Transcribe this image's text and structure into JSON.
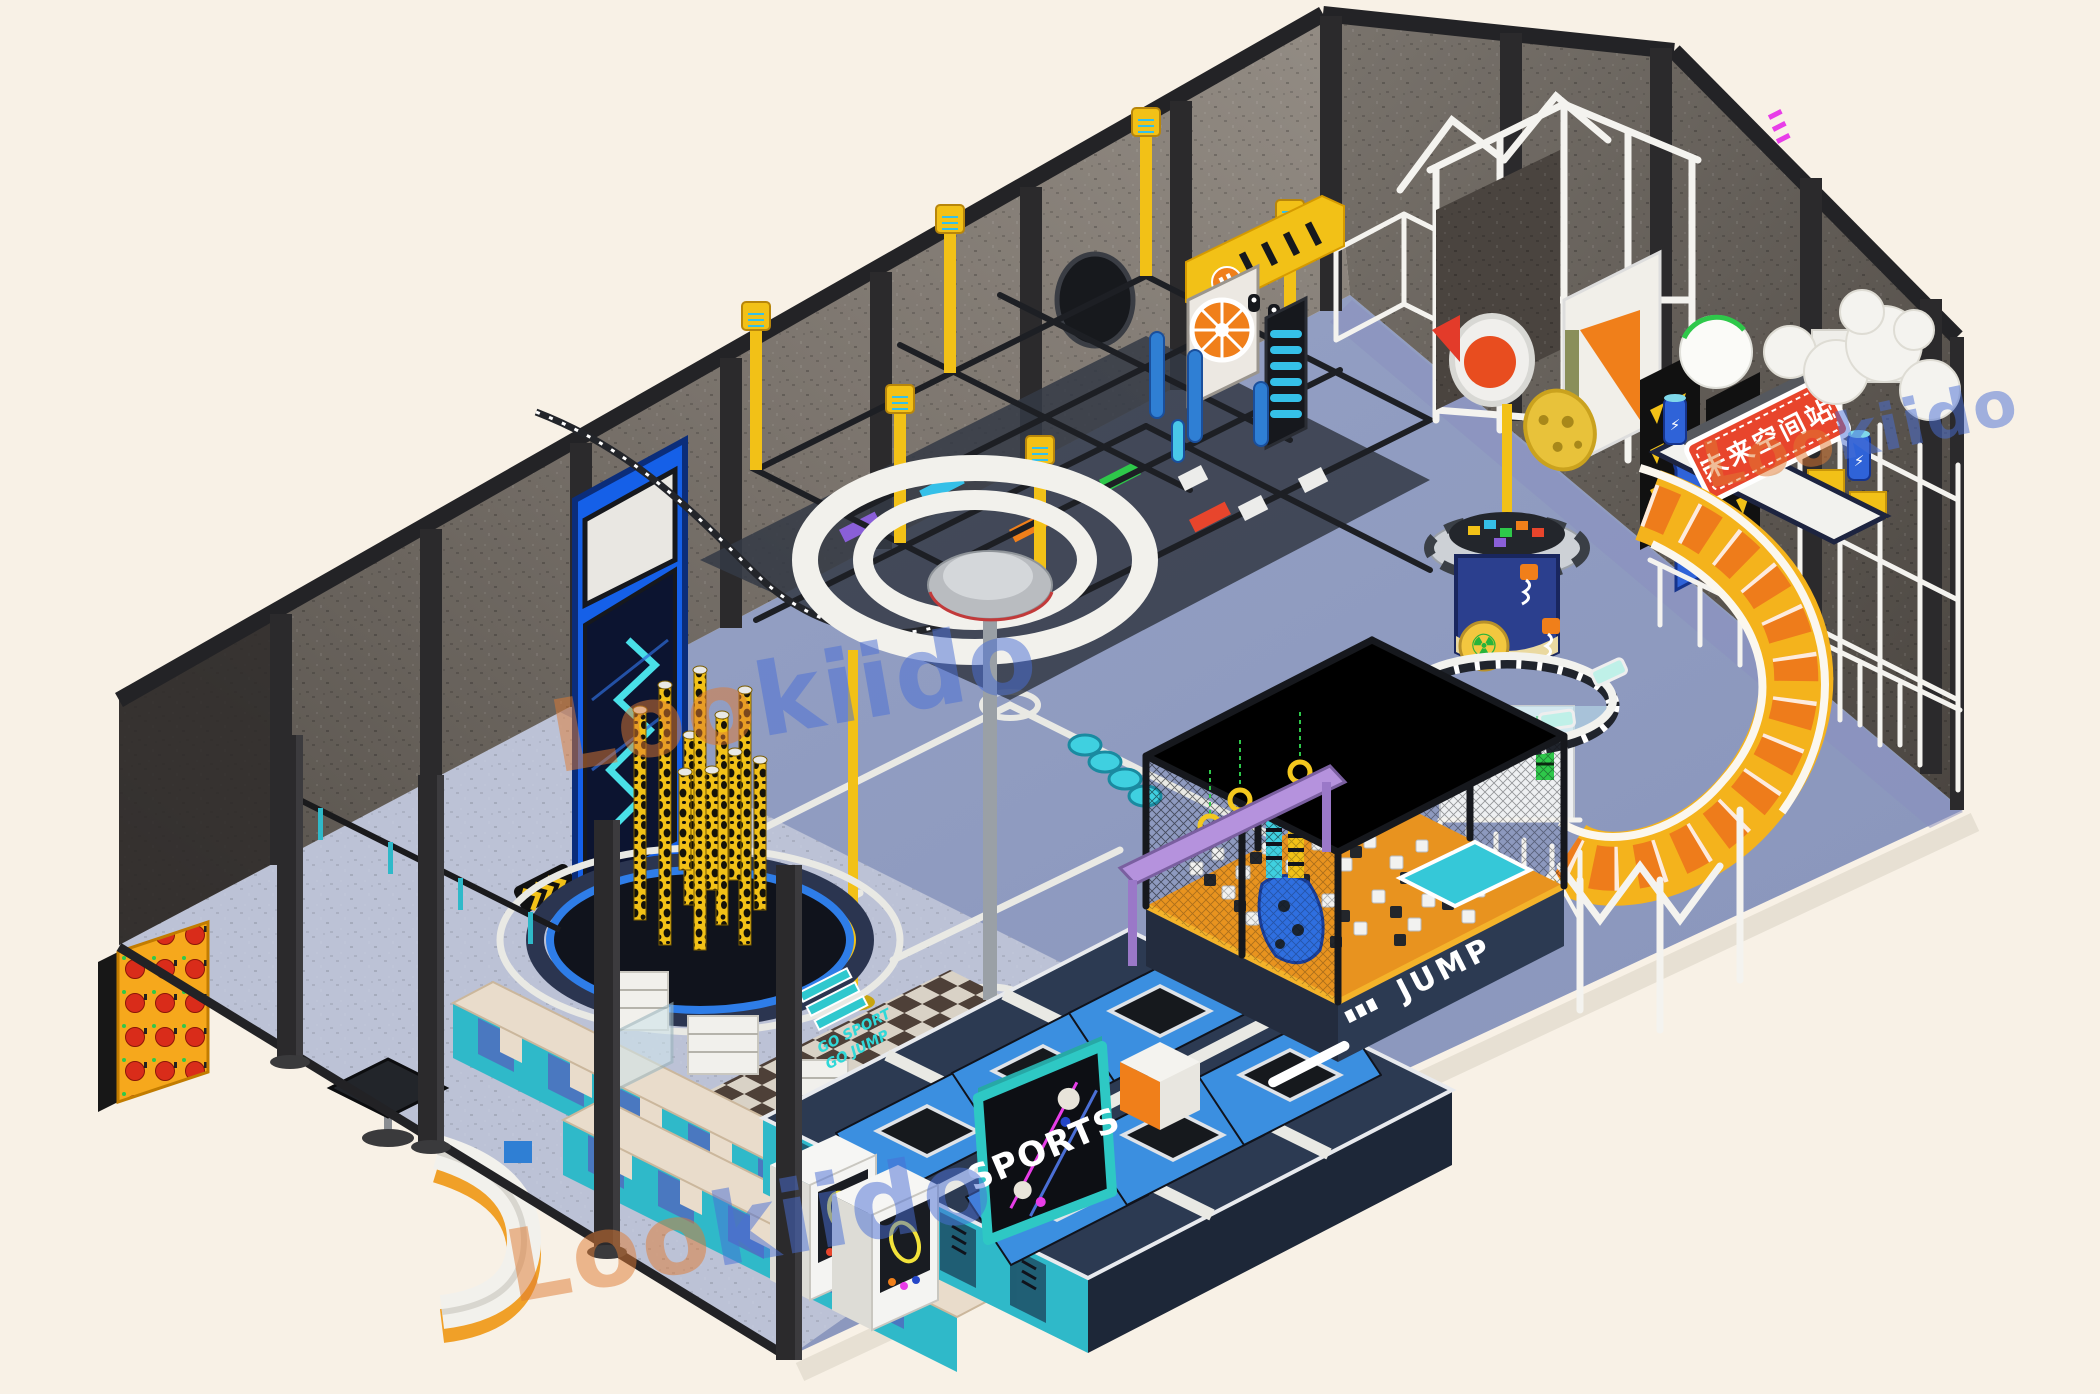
{
  "meta": {
    "title": "Lookiido indoor trampoline and adventure park - isometric 3D render",
    "render_style": "isometric 3D concept render on cream background"
  },
  "colors": {
    "bg": "#f8f1e6",
    "steel": "#26262a",
    "wall_light": "#8f8880",
    "wall_dark": "#55504a",
    "floor_blue": "#8d9bc0",
    "floor_lavender": "#bcc2d6",
    "deck_navy": "#2c3a52",
    "pad_blue": "#3b8fe0",
    "teal": "#2fb9c9",
    "yellow": "#f2c117",
    "orange": "#f07f1a",
    "sign_red": "#e8452c",
    "purple": "#b592dd",
    "tower_blue": "#2b3f8e",
    "slide_yellow": "#f4b31c",
    "slide_orange": "#ee7c1b",
    "glass": "#bfe3ef",
    "wm_orange": "#e07b33",
    "wm_blue": "#4a6fd6",
    "checker_dark": "#4e4038",
    "checker_light": "#d9d2c6",
    "leopard_yellow": "#f2c117",
    "radiation_green": "#27b43a"
  },
  "watermark": {
    "brand": "Lookiido",
    "prefix": "Loo",
    "suffix": "kiido",
    "count": 3
  },
  "signs": {
    "sports": "SPORTS",
    "jump": "JUMP",
    "deck_line1": "GO SPORT",
    "deck_line2": "GO JUMP",
    "led_sign": "未来空间站",
    "arch_label": "머"
  },
  "icons": {
    "radiation_icon": "☢",
    "lightning_icon": "⚡",
    "pause_icon": "⏸"
  }
}
